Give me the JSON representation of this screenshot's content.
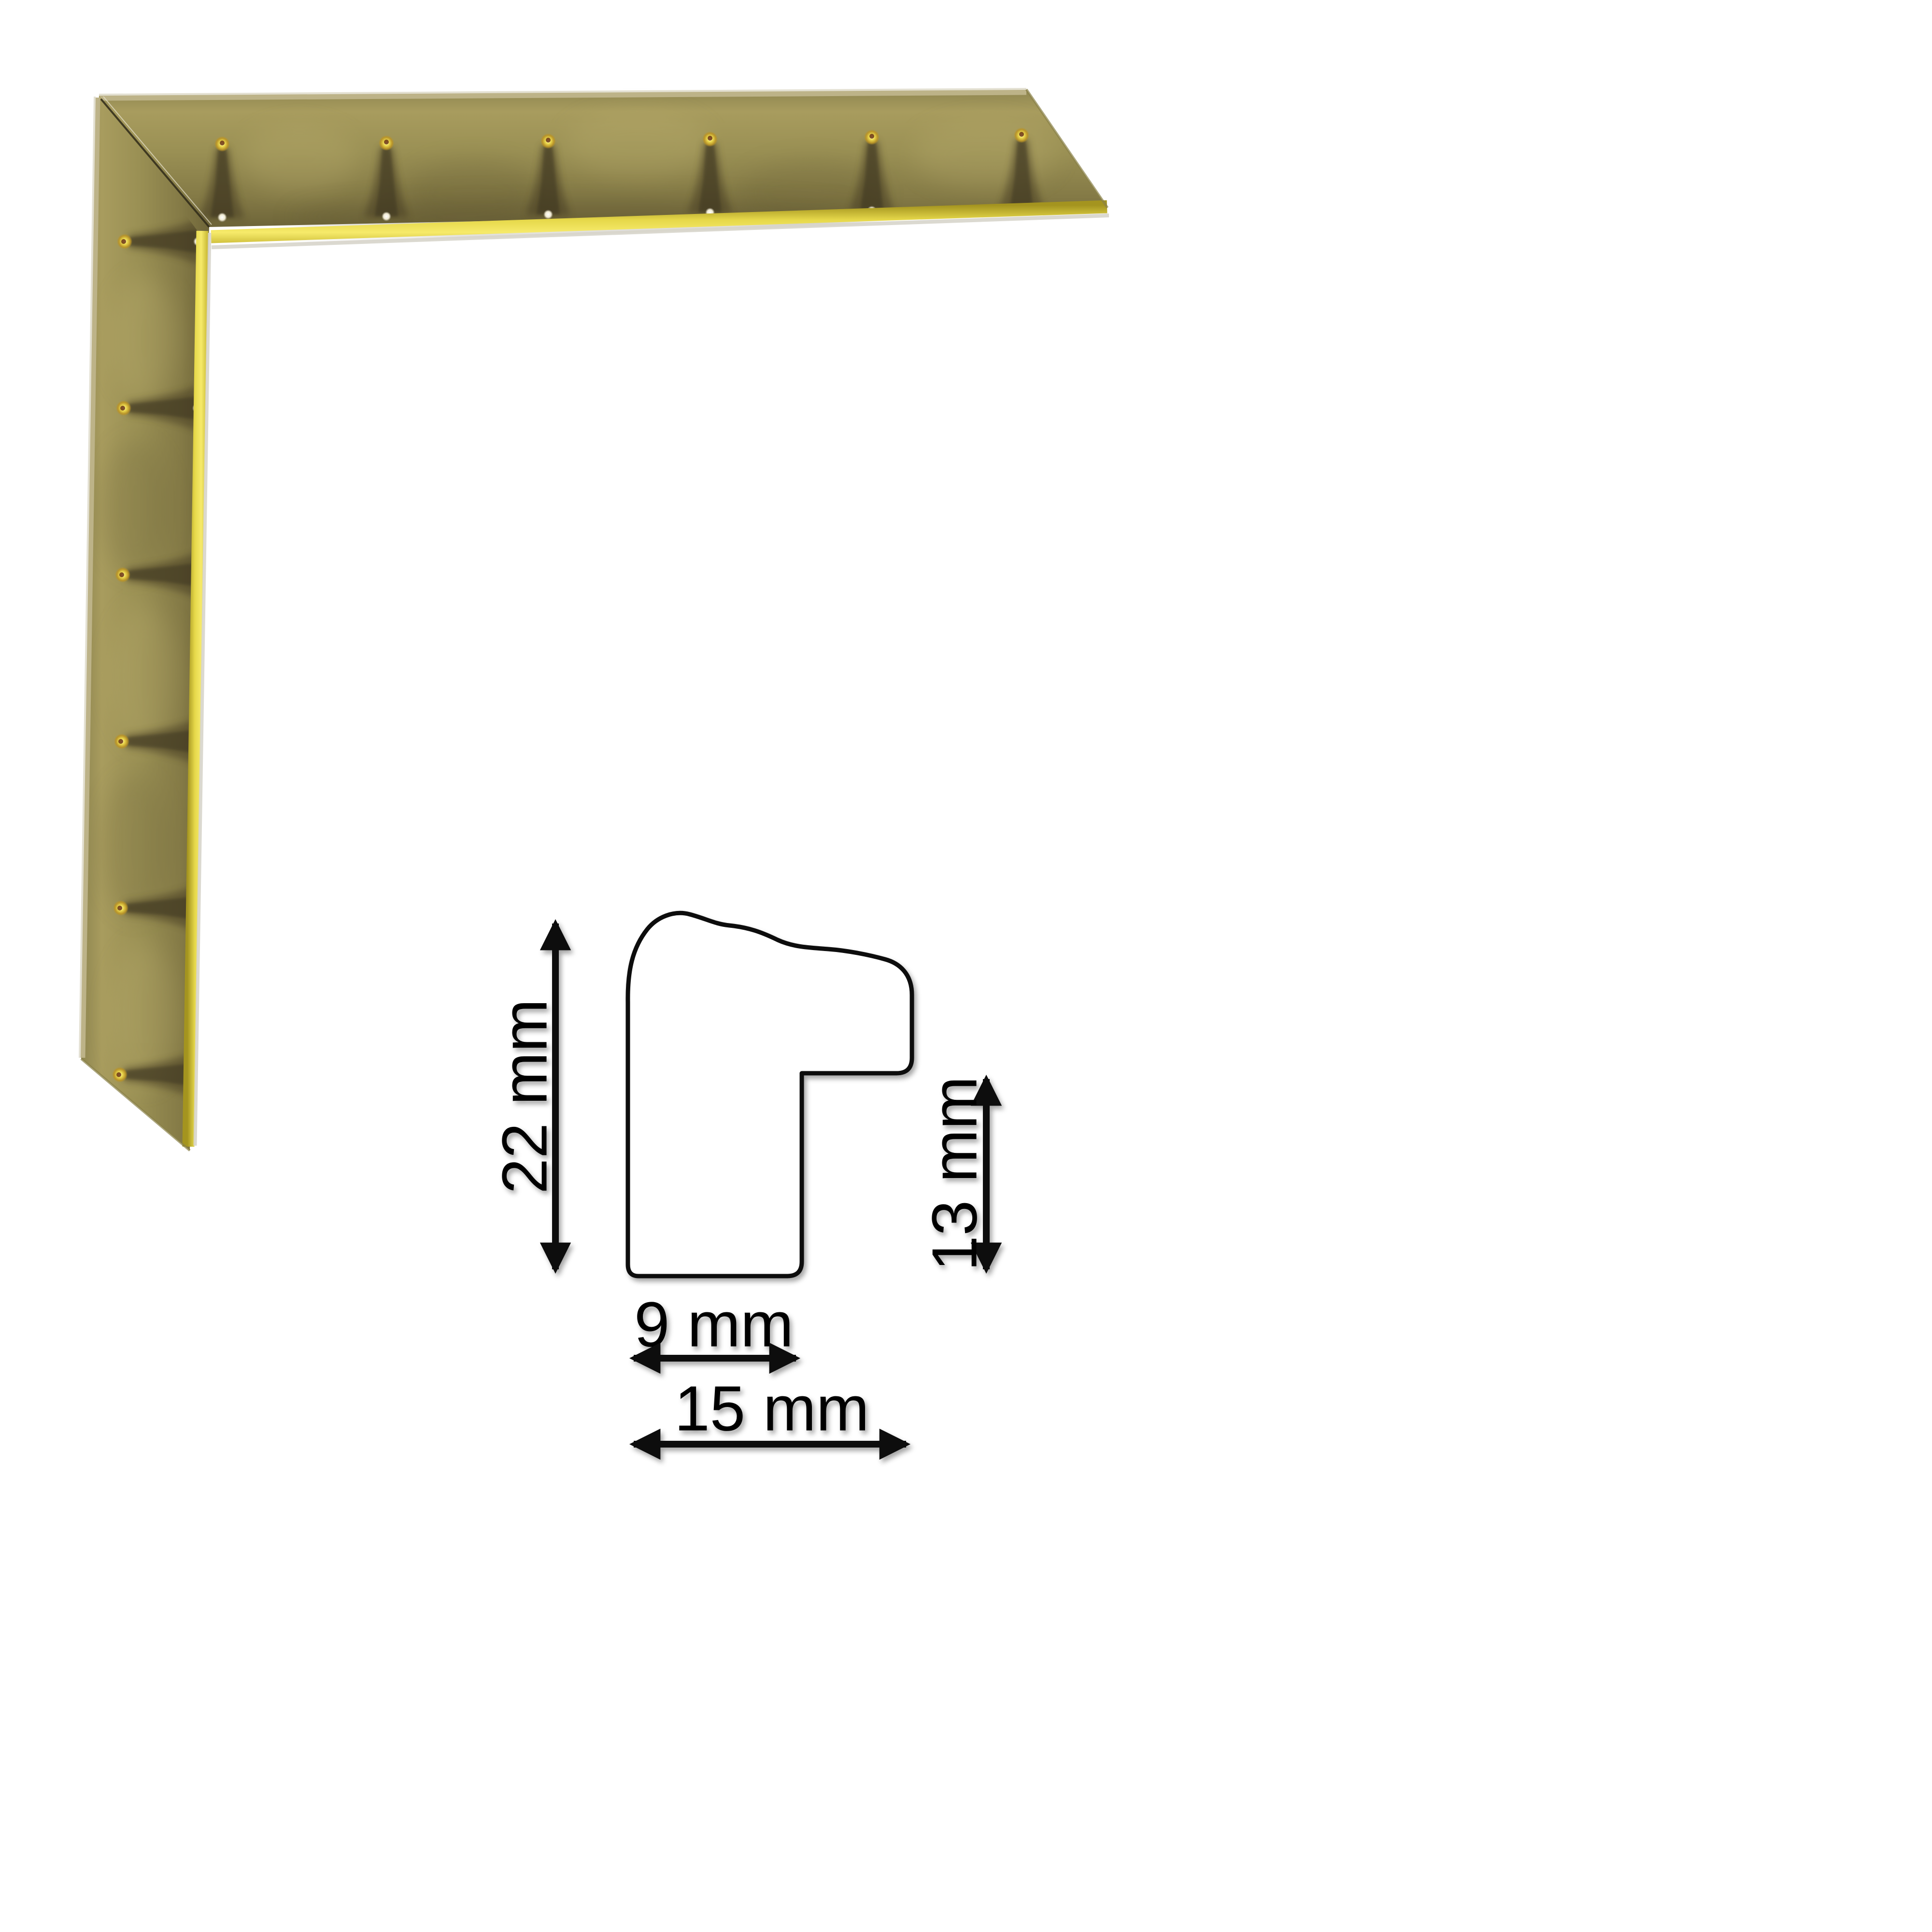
{
  "image": {
    "kind": "picture-frame moulding product sheet",
    "background": "#ffffff"
  },
  "frame_sample": {
    "description": "mitred corner sample of a hammered gold/brass picture-frame moulding",
    "colors": {
      "face_gold": "#9a9054",
      "face_dark": "#6e6539",
      "hammer_band": "#453b24",
      "inner_lip_gold": "#e8d84a",
      "edge_sliver": "#d8d5cb",
      "outer_bevel": "#bdb388"
    }
  },
  "diagram": {
    "stroke_color": "#0d0d0d",
    "labels": {
      "total_height": "22 mm",
      "rabbet_height": "13 mm",
      "face_width": "9 mm",
      "total_width": "15 mm"
    }
  }
}
